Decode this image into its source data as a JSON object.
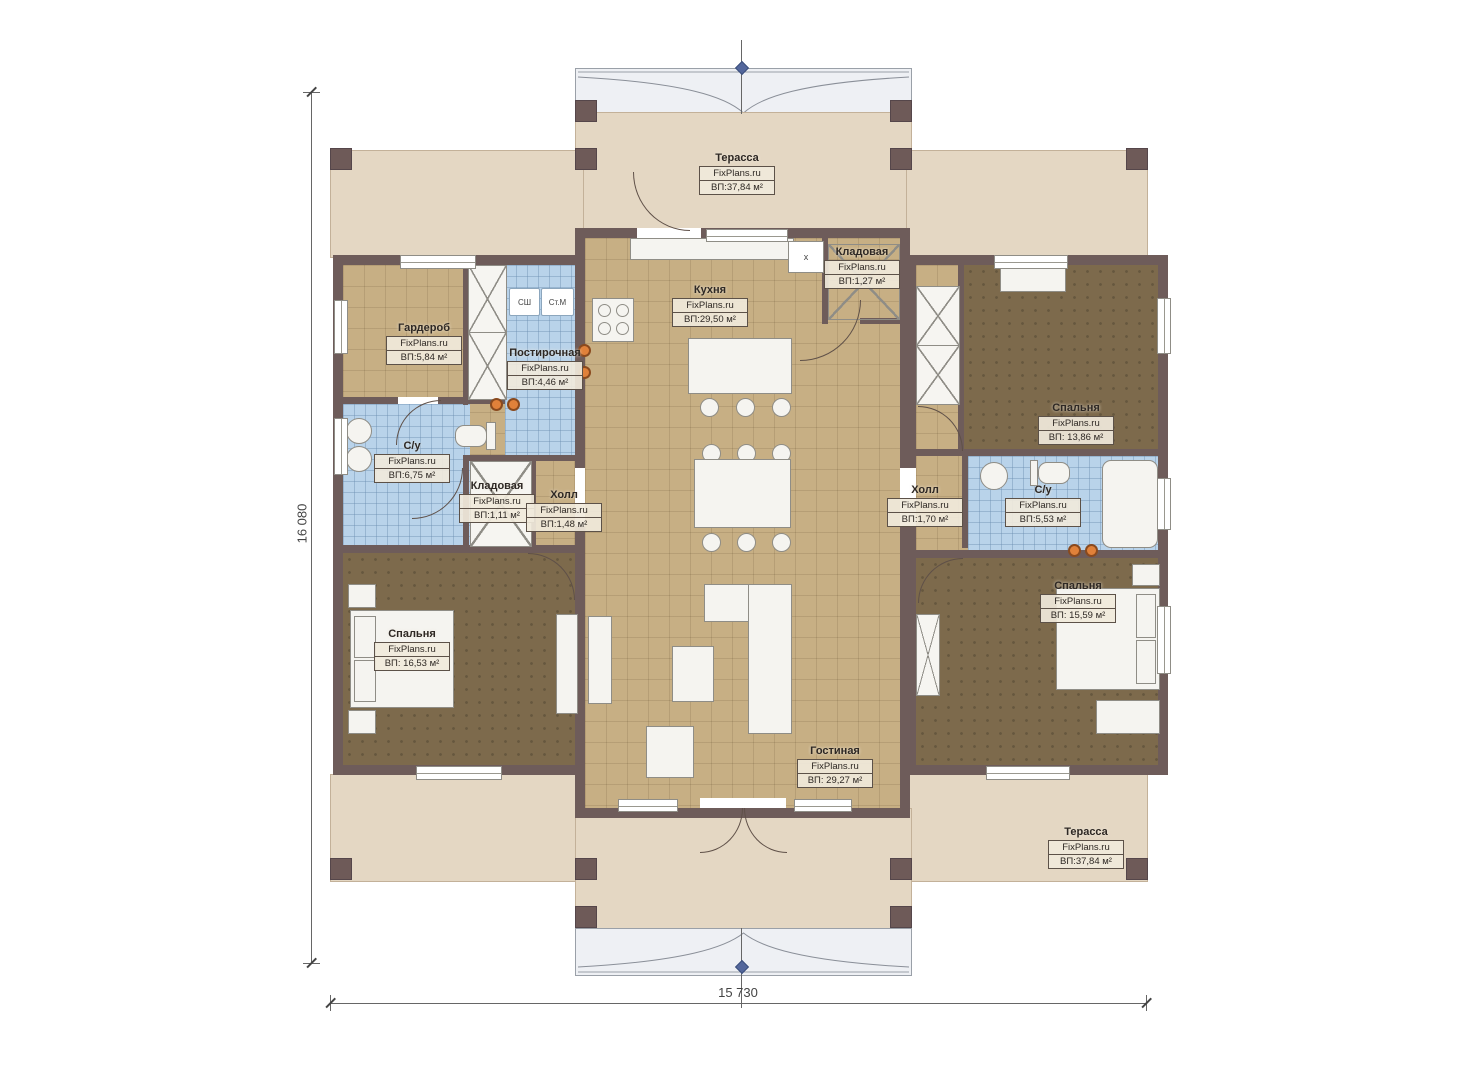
{
  "plan": {
    "height_label": "16 080",
    "width_label": "15 730"
  },
  "rooms": [
    {
      "name": "Терасса",
      "watermark": "FixPlans.ru",
      "area": "ВП:37,84 м²"
    },
    {
      "name": "Кухня",
      "watermark": "FixPlans.ru",
      "area": "ВП:29,50 м²"
    },
    {
      "name": "Кладовая",
      "watermark": "FixPlans.ru",
      "area": "ВП:1,27 м²"
    },
    {
      "name": "Гардероб",
      "watermark": "FixPlans.ru",
      "area": "ВП:5,84 м²"
    },
    {
      "name": "Постирочная",
      "watermark": "FixPlans.ru",
      "area": "ВП:4,46 м²"
    },
    {
      "name": "С/у",
      "watermark": "FixPlans.ru",
      "area": "ВП:6,75 м²"
    },
    {
      "name": "Кладовая",
      "watermark": "FixPlans.ru",
      "area": "ВП:1,11 м²"
    },
    {
      "name": "Холл",
      "watermark": "FixPlans.ru",
      "area": "ВП:1,48 м²"
    },
    {
      "name": "Спальня",
      "watermark": "FixPlans.ru",
      "area": "ВП: 16,53 м²"
    },
    {
      "name": "Холл",
      "watermark": "FixPlans.ru",
      "area": "ВП:1,70 м²"
    },
    {
      "name": "С/у",
      "watermark": "FixPlans.ru",
      "area": "ВП:5,53 м²"
    },
    {
      "name": "Спальня",
      "watermark": "FixPlans.ru",
      "area": "ВП: 13,86 м²"
    },
    {
      "name": "Спальня",
      "watermark": "FixPlans.ru",
      "area": "ВП: 15,59 м²"
    },
    {
      "name": "Гостиная",
      "watermark": "FixPlans.ru",
      "area": "ВП: 29,27 м²"
    },
    {
      "name": "Терасса",
      "watermark": "FixPlans.ru",
      "area": "ВП:37,84 м²"
    }
  ],
  "appliances": {
    "closet_sh": "СШ",
    "washer": "Ст.М",
    "box_x": "x"
  },
  "colors": {
    "wall": "#6e5c5a",
    "terrace": "#e4d7c3",
    "tile_tan": "#c7af84",
    "tile_blue": "#b9d3ea",
    "carpet_brown": "#7d6a4c",
    "roof": "#eef0f4",
    "accent_orange": "#e0813a",
    "marker_blue": "#54679c"
  }
}
